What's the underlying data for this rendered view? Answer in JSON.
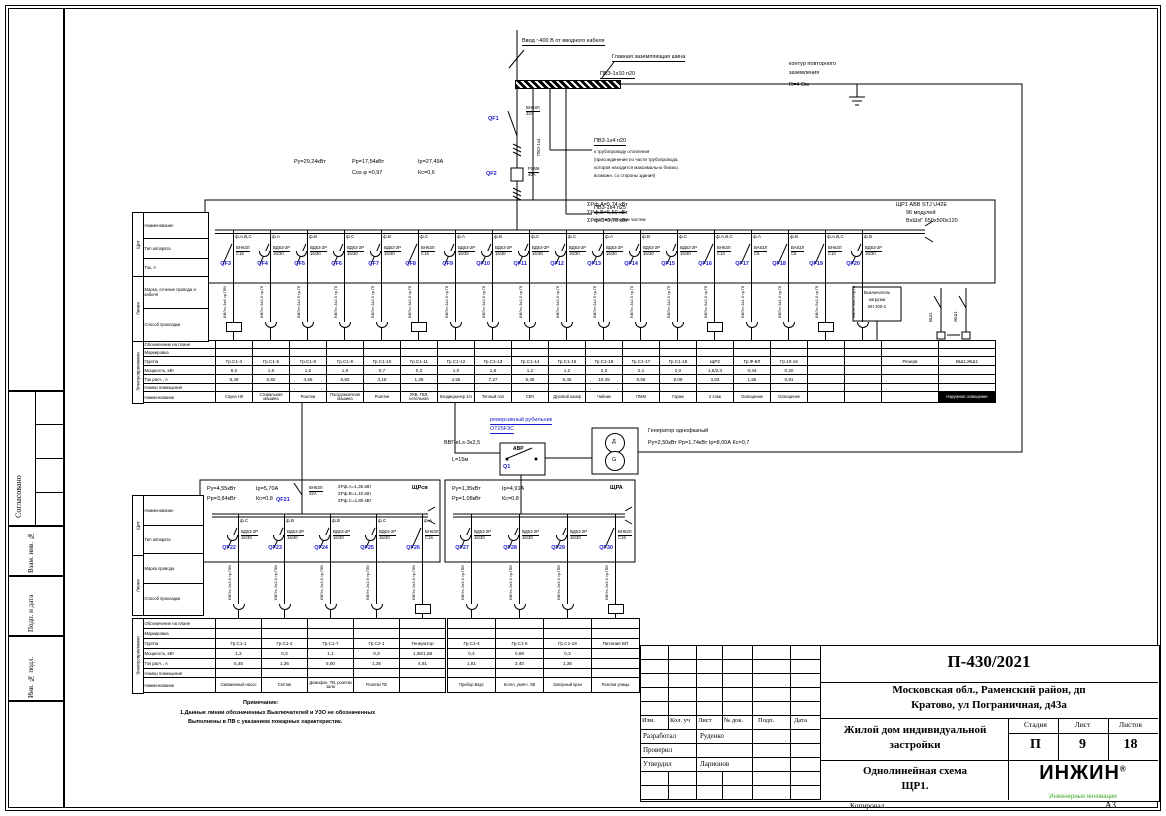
{
  "page": {
    "copied_label": "Копировал",
    "format_label": "А3"
  },
  "left_margin": {
    "agreed": "Согласовано",
    "vzam": "Взам. инв. №",
    "podp": "Подп. и дата",
    "inv": "Инв. № подл."
  },
  "title_block": {
    "doc_number": "П-430/2021",
    "address_line1": "Московская обл., Раменский район, дп",
    "address_line2": "Кратово, ул Пограничная, д43а",
    "object_line1": "Жилой дом индивидуальной",
    "object_line2": "застройки",
    "sheet_name_line1": "Однолинейная схема",
    "sheet_name_line2": "ЩР1.",
    "stage_label": "Стадия",
    "sheet_label": "Лист",
    "sheets_label": "Листов",
    "stage": "П",
    "sheet": "9",
    "sheets": "18",
    "cols": [
      "Изм.",
      "Кол. уч",
      "Лист",
      "№ док.",
      "Подп.",
      "Дата"
    ],
    "rows": [
      {
        "role": "Разработал",
        "name": "Руденко"
      },
      {
        "role": "Проверил",
        "name": ""
      },
      {
        "role": "Утвердил",
        "name": "Ларионов"
      }
    ],
    "logo_text": "ИНЖИН",
    "logo_reg": "®",
    "logo_tagline": "Инженерные инновации",
    "accent_green": "#3fae2a",
    "accent_blue": "#1a1acc"
  },
  "top": {
    "input_label": "Ввод ~400 В от вводного кабеля",
    "gzsh_label": "Главная заземляющая шина",
    "pe_main": "ПВ3-1х10 п20",
    "pe_vert": "ПВ3-1х4",
    "pe_branch1": "ПВ3-1х4 п20",
    "pe_branch1_note1": "к трубопроводу отопления",
    "pe_branch1_note2": "(присоединение по части трубопровода,",
    "pe_branch1_note3": "которая находится максимально близко,",
    "pe_branch1_note4": "возможн. со стороны здания)",
    "pe_branch2": "ПВ3-1х4 п25",
    "pe_branch2_note": "к металлическим частям",
    "earth_note1": "контур повторного",
    "earth_note2": "заземления",
    "earth_note3": "R=4 Ом"
  },
  "incoming": {
    "qf1": {
      "id": "QF1",
      "r1": "ВН63Л",
      "r2": "32А"
    },
    "qf2": {
      "id": "QF2",
      "r1": "РУ5М",
      "r2": "40А"
    },
    "p1": "Ру=29,24кВт",
    "p2": "Рр=17,54кВт",
    "p3": "Iр=27,49А",
    "p4": "Cos φ =0,97",
    "p5": "Кс=0,6"
  },
  "panel": {
    "title_line": "ЩР1    ABB STJ U42E",
    "modules": "96 модулей",
    "dims": "ВхШхГ 650х500х120",
    "phase_sums": [
      "ΣРф.А=5,74 кВт",
      "ΣРф.В=5,50 кВт",
      "ΣРф.С=5,70 кВт"
    ],
    "feeders": [
      {
        "id": "QF3",
        "phase": "ф.А,В,С",
        "type": "plain",
        "r1": "ВН63Л",
        "r2": "С16",
        "c1": "ВВГнг-3х6",
        "c2": "тр.ПВХ",
        "load": "box"
      },
      {
        "id": "QF4",
        "phase": "ф.А",
        "type": "bell",
        "r1": "ВД63-2Р",
        "r2": "16/30",
        "c1": "ВВГнг-3х2,5",
        "c2": "тр.ПВХ",
        "load": "lamp"
      },
      {
        "id": "QF5",
        "phase": "ф.В",
        "type": "bell",
        "r1": "ВД63-2Р",
        "r2": "16/30",
        "c1": "ВВГнг-3х2,5",
        "c2": "тр.ПВХ",
        "load": "lamp"
      },
      {
        "id": "QF6",
        "phase": "ф.С",
        "type": "bell",
        "r1": "ВД63-2Р",
        "r2": "16/30",
        "c1": "ВВГнг-3х2,5",
        "c2": "тр.ПВХ",
        "load": "lamp"
      },
      {
        "id": "QF7",
        "phase": "ф.В",
        "type": "bell",
        "r1": "ВД63-2Р",
        "r2": "16/30",
        "c1": "ВВГнг-3х2,5",
        "c2": "тр.ПВХ",
        "load": "lamp"
      },
      {
        "id": "QF8",
        "phase": "ф.С",
        "type": "plain",
        "r1": "ВН63Л",
        "r2": "С16",
        "c1": "ВВГнг-3х2,5",
        "c2": "тр.ПВХ",
        "load": "box"
      },
      {
        "id": "QF9",
        "phase": "ф.А",
        "type": "bell",
        "r1": "ВД63-2Р",
        "r2": "16/30",
        "c1": "ВВГнг-3х2,5",
        "c2": "тр.ПВХ",
        "load": "lamp"
      },
      {
        "id": "QF10",
        "phase": "ф.В",
        "type": "bell",
        "r1": "ВД63-2Р",
        "r2": "16/30",
        "c1": "ВВГнг-3х2,5",
        "c2": "тр.ПВХ",
        "load": "lamp"
      },
      {
        "id": "QF11",
        "phase": "ф.С",
        "type": "bell",
        "r1": "ВД63-2Р",
        "r2": "16/30",
        "c1": "ВВГнг-3х2,5",
        "c2": "тр.ПВХ",
        "load": "lamp"
      },
      {
        "id": "QF12",
        "phase": "ф.С",
        "type": "bell",
        "r1": "ВД63-2Р",
        "r2": "16/30",
        "c1": "ВВГнг-3х2,5",
        "c2": "тр.ПВХ",
        "load": "lamp"
      },
      {
        "id": "QF13",
        "phase": "ф.А",
        "type": "bell",
        "r1": "ВД63-2Р",
        "r2": "16/30",
        "c1": "ВВГнг-3х2,5",
        "c2": "тр.ПВХ",
        "load": "lamp"
      },
      {
        "id": "QF14",
        "phase": "ф.В",
        "type": "bell",
        "r1": "ВД63-2Р",
        "r2": "16/30",
        "c1": "ВВГнг-3х2,5",
        "c2": "тр.ПВХ",
        "load": "lamp"
      },
      {
        "id": "QF15",
        "phase": "ф.С",
        "type": "bell",
        "r1": "ВД63-2Р",
        "r2": "16/30",
        "c1": "ВВГнг-3х2,5",
        "c2": "тр.ПВХ",
        "load": "lamp"
      },
      {
        "id": "QF16",
        "phase": "ф.А,В,С",
        "type": "plain",
        "r1": "ВН63Л",
        "r2": "С10",
        "c1": "ВВГнг-5х2,5",
        "c2": "тр.ПВХ",
        "load": "box"
      },
      {
        "id": "QF17",
        "phase": "ф.А",
        "type": "plain",
        "r1": "ВА63Л",
        "r2": "С6",
        "c1": "ВВГнг-3х1,5",
        "c2": "тр.ПВХ",
        "load": "lamp"
      },
      {
        "id": "QF18",
        "phase": "ф.В",
        "type": "plain",
        "r1": "ВА63Л",
        "r2": "С6",
        "c1": "ВВГнг-3х1,5",
        "c2": "тр.ПВХ",
        "load": "lamp"
      },
      {
        "id": "QF19",
        "phase": "ф.А,В,С",
        "type": "plain",
        "r1": "ВН63Л",
        "r2": "С10",
        "c1": "ВВГнг-5х2,5",
        "c2": "тр.ПВХ",
        "load": "box"
      },
      {
        "id": "QF20",
        "phase": "ф.В",
        "type": "bell",
        "r1": "ВД63-2Р",
        "r2": "16/30",
        "c1": "ВВГнг-3х2,5",
        "c2": "тр.ПВХ",
        "load": "lamp"
      }
    ],
    "vsh_label": "ВШ1",
    "zsh_label": "ЖШ1",
    "box200": {
      "l1": "Выключатель",
      "l2": "нагрузки",
      "l3": "ВН 200-4"
    }
  },
  "table_row_labels": [
    "Обозначение на плане",
    "Маркировка",
    "Группа",
    "Мощность, кВт",
    "Ток расч., А",
    "Номер помещения",
    "Наименование"
  ],
  "col_headers": {
    "strip_shield": "Щит",
    "strip_line": "Линия",
    "strip_loads": "Электроприемники",
    "main": [
      "Наименование",
      "Тип аппарата",
      "Ток, А",
      "Марка, сечение провода и кабеля",
      "Способ прокладки"
    ],
    "sub": [
      "Наименование",
      "Тип аппарата",
      "Марка провода",
      "Способ прокладки"
    ]
  },
  "main_table": {
    "columns": [
      {
        "g": "Гр.С1-3",
        "p": "6,0",
        "c": "8,49",
        "n": "Сауна НК"
      },
      {
        "g": "Гр.С1-5",
        "p": "1,6",
        "c": "6,92",
        "n": "Стиральная машина"
      },
      {
        "g": "Гр.С1-8",
        "p": "1,0",
        "c": "4,55",
        "n": "Розетки"
      },
      {
        "g": "Гр.С1-9",
        "p": "1,5",
        "c": "6,82",
        "n": "Посудомоечная машина"
      },
      {
        "g": "Гр.С1-10",
        "p": "0,7",
        "c": "3,18",
        "n": "Розетки"
      },
      {
        "g": "Гр.С1-11",
        "p": "0,3",
        "c": "1,36",
        "n": "УКВ, ГВЛ, котельная"
      },
      {
        "g": "Гр.С1-12",
        "p": "1,0",
        "c": "4,55",
        "n": "Кондиционер 1эт"
      },
      {
        "g": "Гр.С1-13",
        "p": "1,6",
        "c": "7,27",
        "n": "Теплый пол"
      },
      {
        "g": "Гр.С1-14",
        "p": "1,2",
        "c": "5,45",
        "n": "СВЧ"
      },
      {
        "g": "Гр.С1-15",
        "p": "1,2",
        "c": "5,45",
        "n": "Духовой шкаф"
      },
      {
        "g": "Гр.С1-16",
        "p": "2,3",
        "c": "10,45",
        "n": "Чайник"
      },
      {
        "g": "Гр.С1-17",
        "p": "2,1",
        "c": "9,55",
        "n": "ПММ"
      },
      {
        "g": "Гр.С1-18",
        "p": "2,0",
        "c": "9,09",
        "n": "Гараж"
      },
      {
        "g": "ЩР2",
        "p": "1,5/2,3",
        "c": "3,83",
        "n": "2 этаж"
      },
      {
        "g": "Гр.Ф-8Л",
        "p": "0,34",
        "c": "1,55",
        "n": "Освещение"
      },
      {
        "g": "Гр.10-16",
        "p": "0,20",
        "c": "0,91",
        "n": "Освещение"
      },
      {
        "g": "",
        "p": "",
        "c": "",
        "n": ""
      },
      {
        "g": "",
        "p": "",
        "c": "",
        "n": ""
      },
      {
        "g": "Резерв",
        "p": "",
        "c": "",
        "n": ""
      },
      {
        "g": "ВШ1,ЖШ1",
        "p": "",
        "c": "",
        "n": "Наружное освещение",
        "inv": true
      }
    ]
  },
  "sub_left": {
    "name": "ЩРсв",
    "p1": "Ру=4,55кВт",
    "p2": "Рр=3,84кВт",
    "p3": "Iр=5,70А",
    "p4": "Кс=0,8",
    "qf21": {
      "id": "QF21",
      "r1": "ВН63Л",
      "r2": "32А"
    },
    "phase_sums": [
      "ΣРф.А=1,35 кВт",
      "ΣРф.В=1,40 кВт",
      "ΣРф.С=1,80 кВт"
    ],
    "feeders": [
      {
        "id": "QF22",
        "phase": "ф.С",
        "type": "bell",
        "r1": "ВД63-2Р",
        "r2": "16/30",
        "c1": "ВВГнг-3х2,5",
        "c2": "тр.ПВХ",
        "load": "lamp"
      },
      {
        "id": "QF23",
        "phase": "ф.В",
        "type": "bell",
        "r1": "ВД63-2Р",
        "r2": "16/30",
        "c1": "ВВГнг-3х2,5",
        "c2": "тр.ПВХ",
        "load": "lamp"
      },
      {
        "id": "QF24",
        "phase": "ф.В",
        "type": "bell",
        "r1": "ВД63-2Р",
        "r2": "16/30",
        "c1": "ВВГнг-3х2,5",
        "c2": "тр.ПВХ",
        "load": "lamp"
      },
      {
        "id": "QF25",
        "phase": "ф.С",
        "type": "bell",
        "r1": "ВД63-2Р",
        "r2": "16/30",
        "c1": "ВВГнг-3х2,5",
        "c2": "тр.ПВХ",
        "load": "lamp"
      },
      {
        "id": "QF26",
        "phase": "ф.А",
        "type": "plain",
        "r1": "ВН63Л",
        "r2": "С16",
        "c1": "ВВГнг-3х2,5",
        "c2": "тр.ПВХ",
        "load": "box"
      }
    ],
    "table": {
      "columns": [
        {
          "g": "Гр.С1-1",
          "p": "1,2",
          "c": "5,45",
          "n": "Скважинный насос"
        },
        {
          "g": "Гр.С1-2",
          "p": "0,3",
          "c": "1,36",
          "n": "Септик"
        },
        {
          "g": "Гр.С1-7",
          "p": "1,1",
          "c": "5,00",
          "n": "Домофон, ТВ, розетки зала"
        },
        {
          "g": "Гр.С2-1",
          "p": "0,3",
          "c": "1,36",
          "n": "Розетки ТВ"
        },
        {
          "g": "Генератор",
          "p": "1,36/1,68",
          "c": "4,91",
          "n": ""
        }
      ]
    }
  },
  "sub_right": {
    "name": "ЩРА",
    "p1": "Ру=1,35кВт",
    "p2": "Рр=1,08кВт",
    "p3": "Iр=4,91А",
    "p4": "Кс=0,8",
    "feeders": [
      {
        "id": "QF27",
        "phase": "",
        "type": "bell",
        "r1": "ВД63-2Р",
        "r2": "16/30",
        "c1": "ВВГнг-3х2,5",
        "c2": "тр.ПВХ",
        "load": "lamp"
      },
      {
        "id": "QF28",
        "phase": "",
        "type": "bell",
        "r1": "ВД63-2Р",
        "r2": "16/30",
        "c1": "ВВГнг-3х2,5",
        "c2": "тр.ПВХ",
        "load": "lamp"
      },
      {
        "id": "QF29",
        "phase": "",
        "type": "bell",
        "r1": "ВД63-2Р",
        "r2": "16/30",
        "c1": "ВВГнг-3х2,5",
        "c2": "тр.ПВХ",
        "load": "lamp"
      },
      {
        "id": "QF30",
        "phase": "",
        "type": "plain",
        "r1": "ВН63Л",
        "r2": "С16",
        "c1": "ВВГнг-3х2,5",
        "c2": "тр.ПВХ",
        "load": "box"
      }
    ],
    "table": {
      "columns": [
        {
          "g": "Гр.С1-4",
          "p": "0,4",
          "c": "1,81",
          "n": "Прибор Барс"
        },
        {
          "g": "Гр.С1-6",
          "p": "0,88",
          "c": "2,40",
          "n": "Котел, умягч. ХВ"
        },
        {
          "g": "Гр.С1-19",
          "p": "0,3",
          "c": "1,36",
          "n": "Запорный кран"
        },
        {
          "g": "Питание БП",
          "p": "",
          "c": "",
          "n": "Розетки улицы"
        }
      ]
    }
  },
  "avr": {
    "label": "АВР",
    "q1": "Q1",
    "note1": "реверсивный рубильник",
    "note2": "ОТ25F3C",
    "cable1": "ВВГнгLs-3х2,5",
    "cable2": "L=15м"
  },
  "generator": {
    "title": "Генератор однофазный",
    "params": "Ру=2,50кВт    Рр=1,74кВт    Iр=8,00А    Кс=0,7",
    "sym_top": "Д",
    "sym_bottom": "G"
  },
  "notes": {
    "title": "Примечание:",
    "line1": "1.Данные линии обозначенных Выключателей и УЗО не обозначенных",
    "line2": "Выполнены в ПВ с указанием пожарных характеристик."
  }
}
